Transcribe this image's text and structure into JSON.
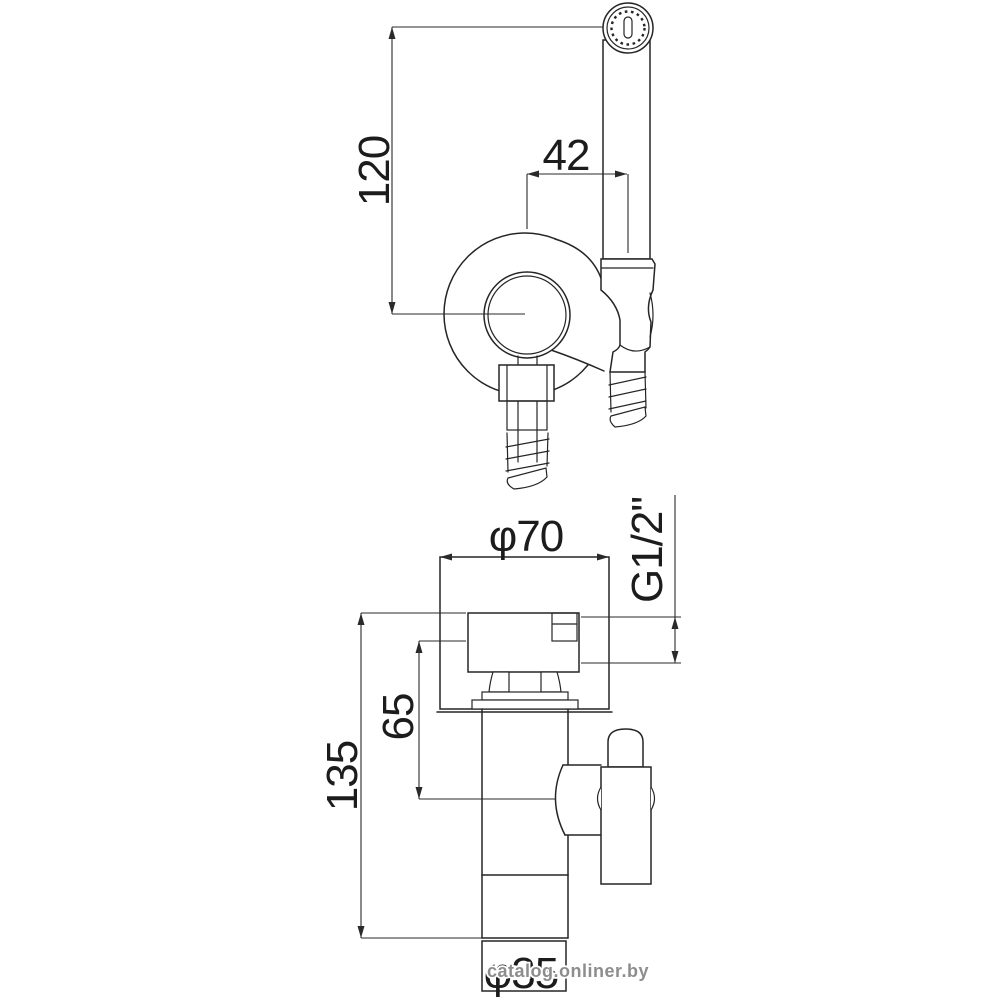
{
  "drawing": {
    "type": "technical-dimension-diagram",
    "subject": "hygienic shower set (bidet sprayer with holder and angle valve)",
    "background": "#ffffff",
    "line_color": "#252525",
    "top_view": {
      "dim_height": "120",
      "dim_offset": "42"
    },
    "bottom_view": {
      "dim_plate_diameter": "φ70",
      "dim_thread": "G1/2\"",
      "dim_inlet_depth": "65",
      "dim_total_height": "135",
      "dim_pipe_diameter": "φ35"
    },
    "watermark": {
      "text": "catalog.onliner.by",
      "color": "#8d8d8d"
    }
  }
}
